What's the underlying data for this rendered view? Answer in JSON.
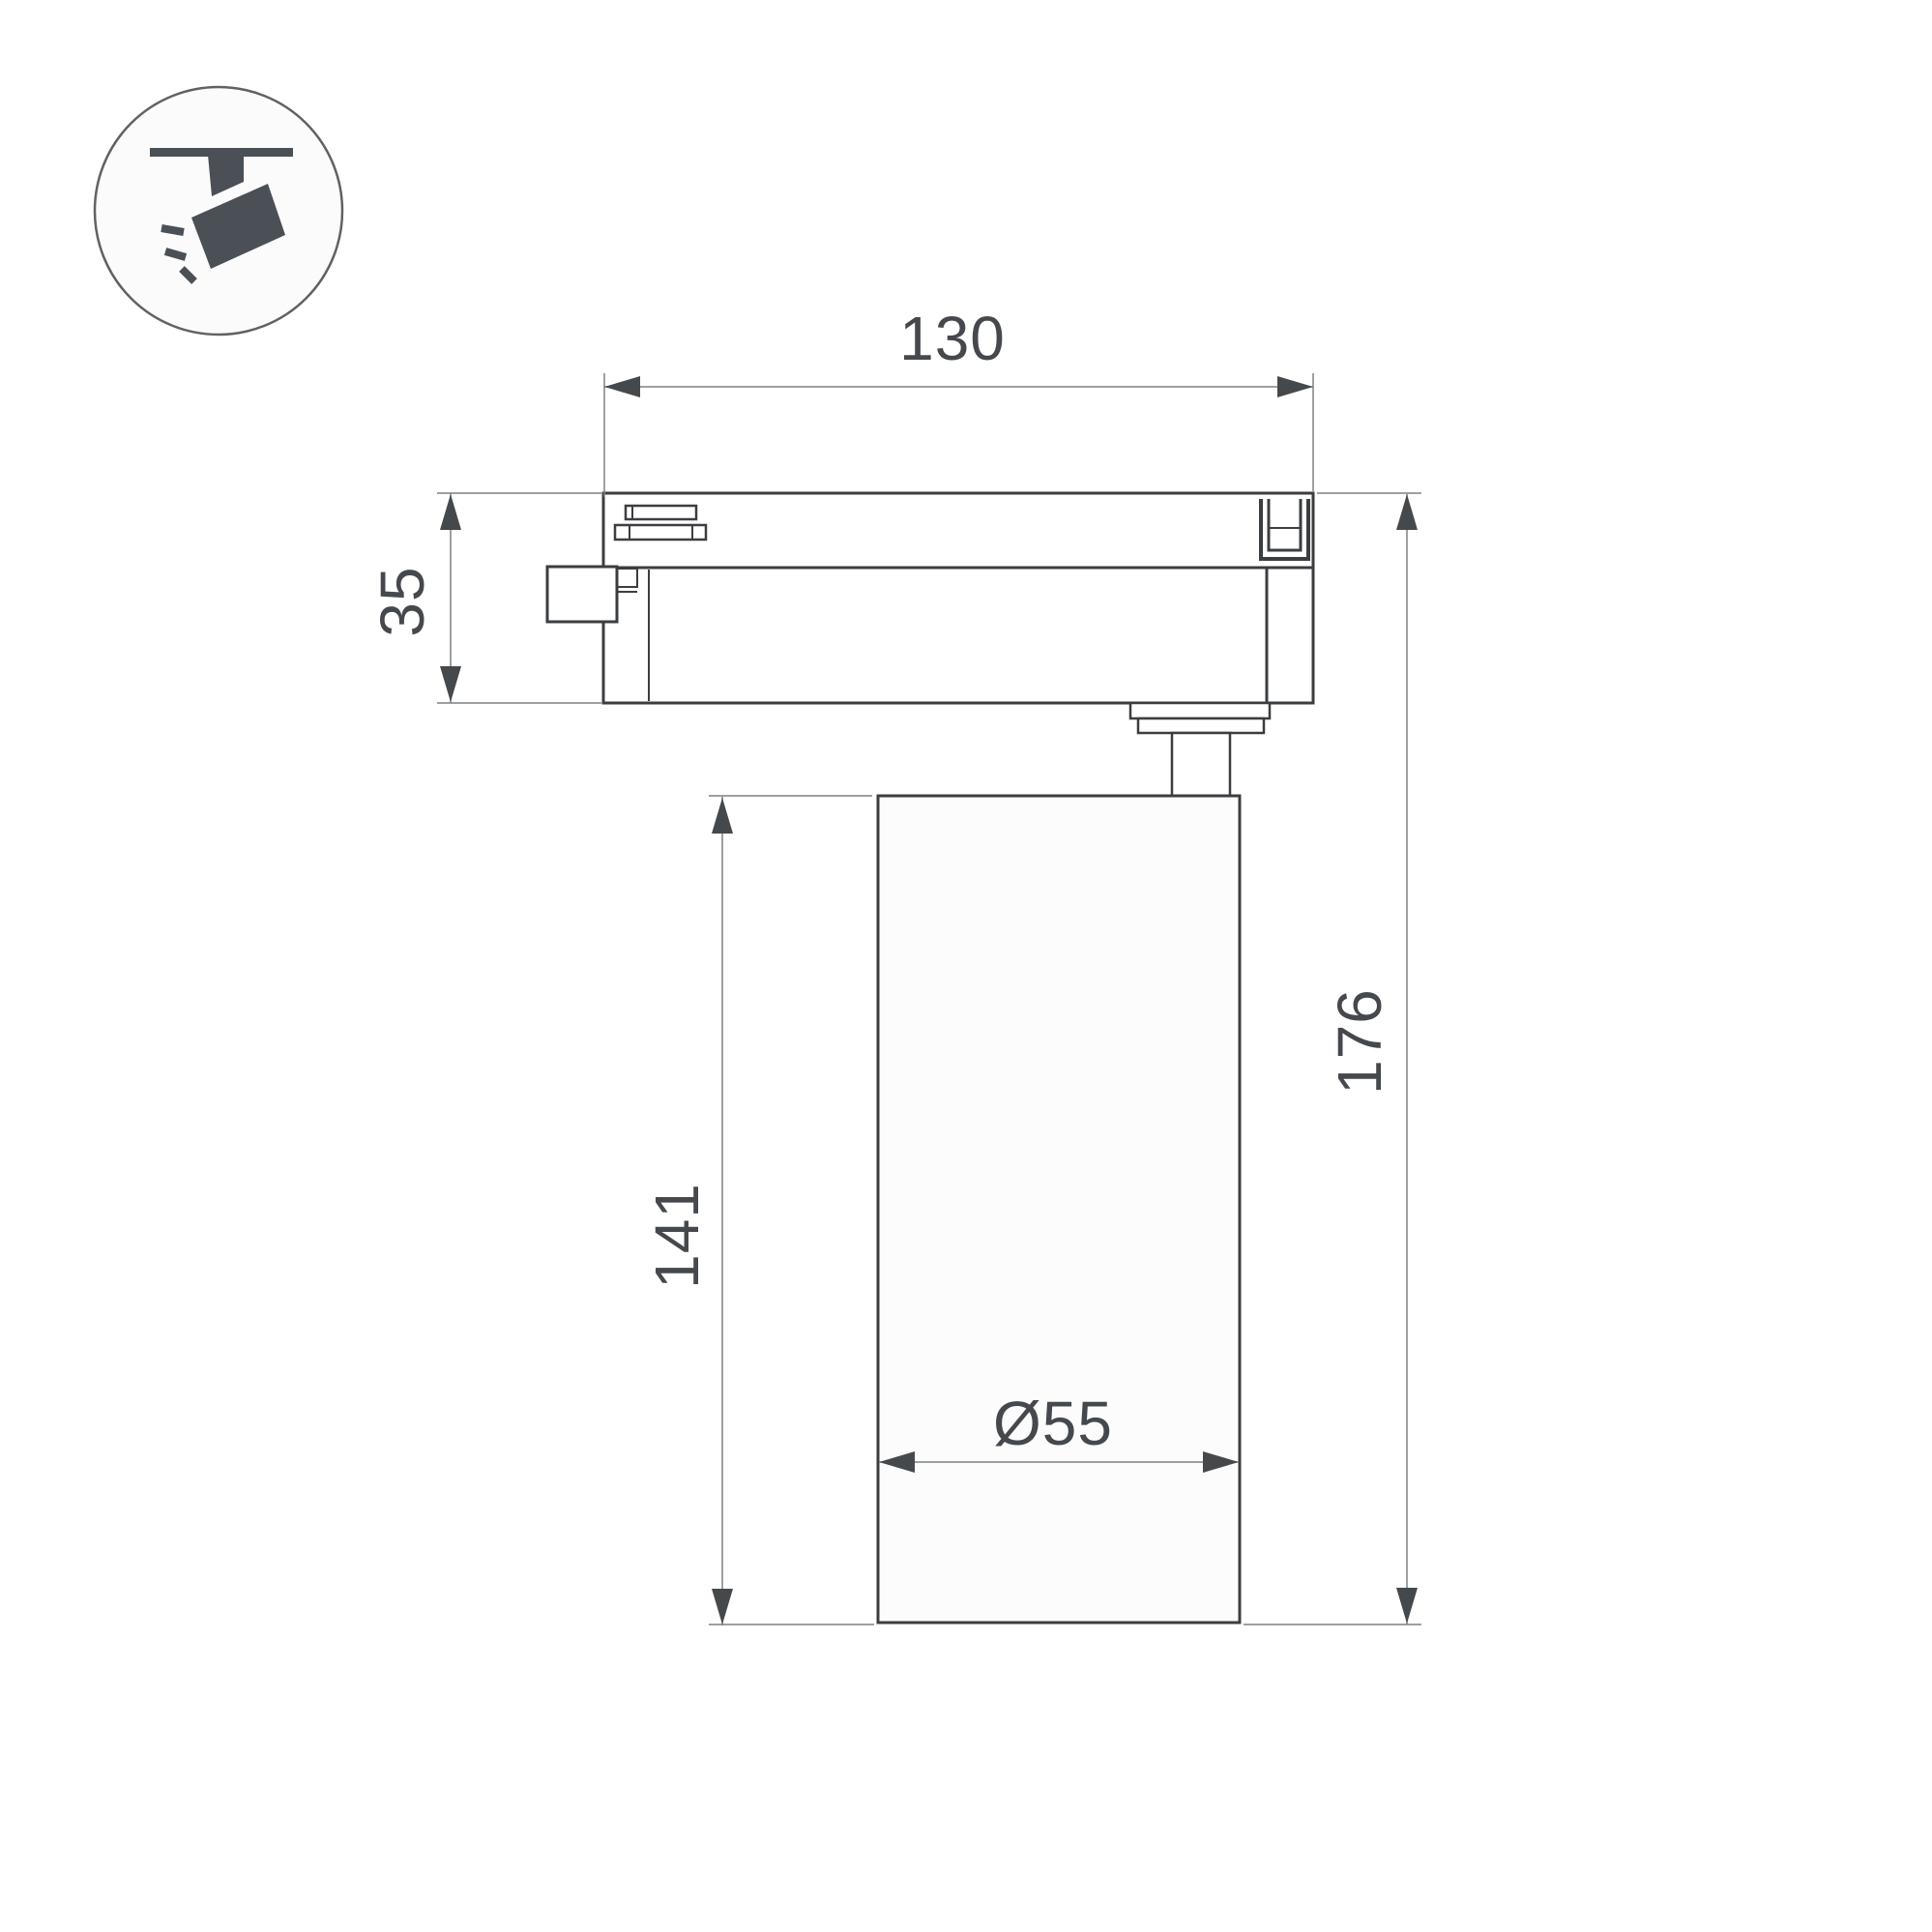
{
  "drawing": {
    "title": "track-spotlight-dimension-drawing",
    "view": "side-view-technical-drawing",
    "labels": {
      "track_width": "130",
      "adapter_height": "35",
      "body_height": "141",
      "total_height": "176",
      "body_diameter": "Ø55"
    },
    "icon": {
      "name": "track-spotlight-icon",
      "description": "spotlight hanging from ceiling track with light rays"
    },
    "colors": {
      "background": "#ffffff",
      "outline": "#3b3e41",
      "dimension_line": "#7d8083",
      "arrow": "#46494c",
      "text": "#45484c",
      "icon_glyph": "#4a5055"
    }
  }
}
